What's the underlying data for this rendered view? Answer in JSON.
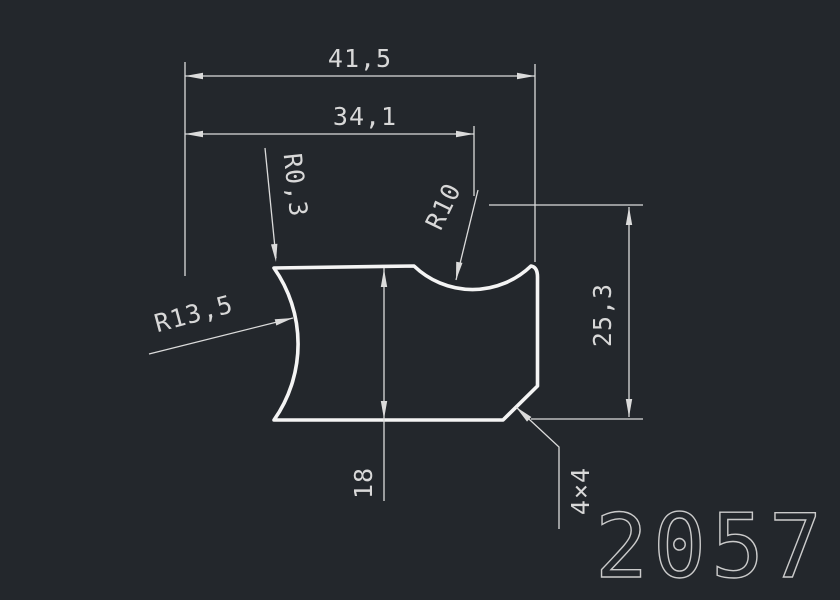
{
  "drawing": {
    "part_number": "2057",
    "labels": {
      "dim_total_width": "41,5",
      "dim_arc_center_offset": "34,1",
      "dim_height_right": "25,3",
      "dim_height_left": "18",
      "radius_fillet_top_left": "R0,3",
      "radius_top_arc": "R10",
      "radius_left_arc": "R13,5",
      "chamfer": "4×4"
    }
  },
  "colors": {
    "background": "#23272c",
    "geometry": "#f4f4f4",
    "dimension": "#dbdbdb",
    "text": "#d8d8d8",
    "part_number_stroke": "#cbcbcb"
  }
}
